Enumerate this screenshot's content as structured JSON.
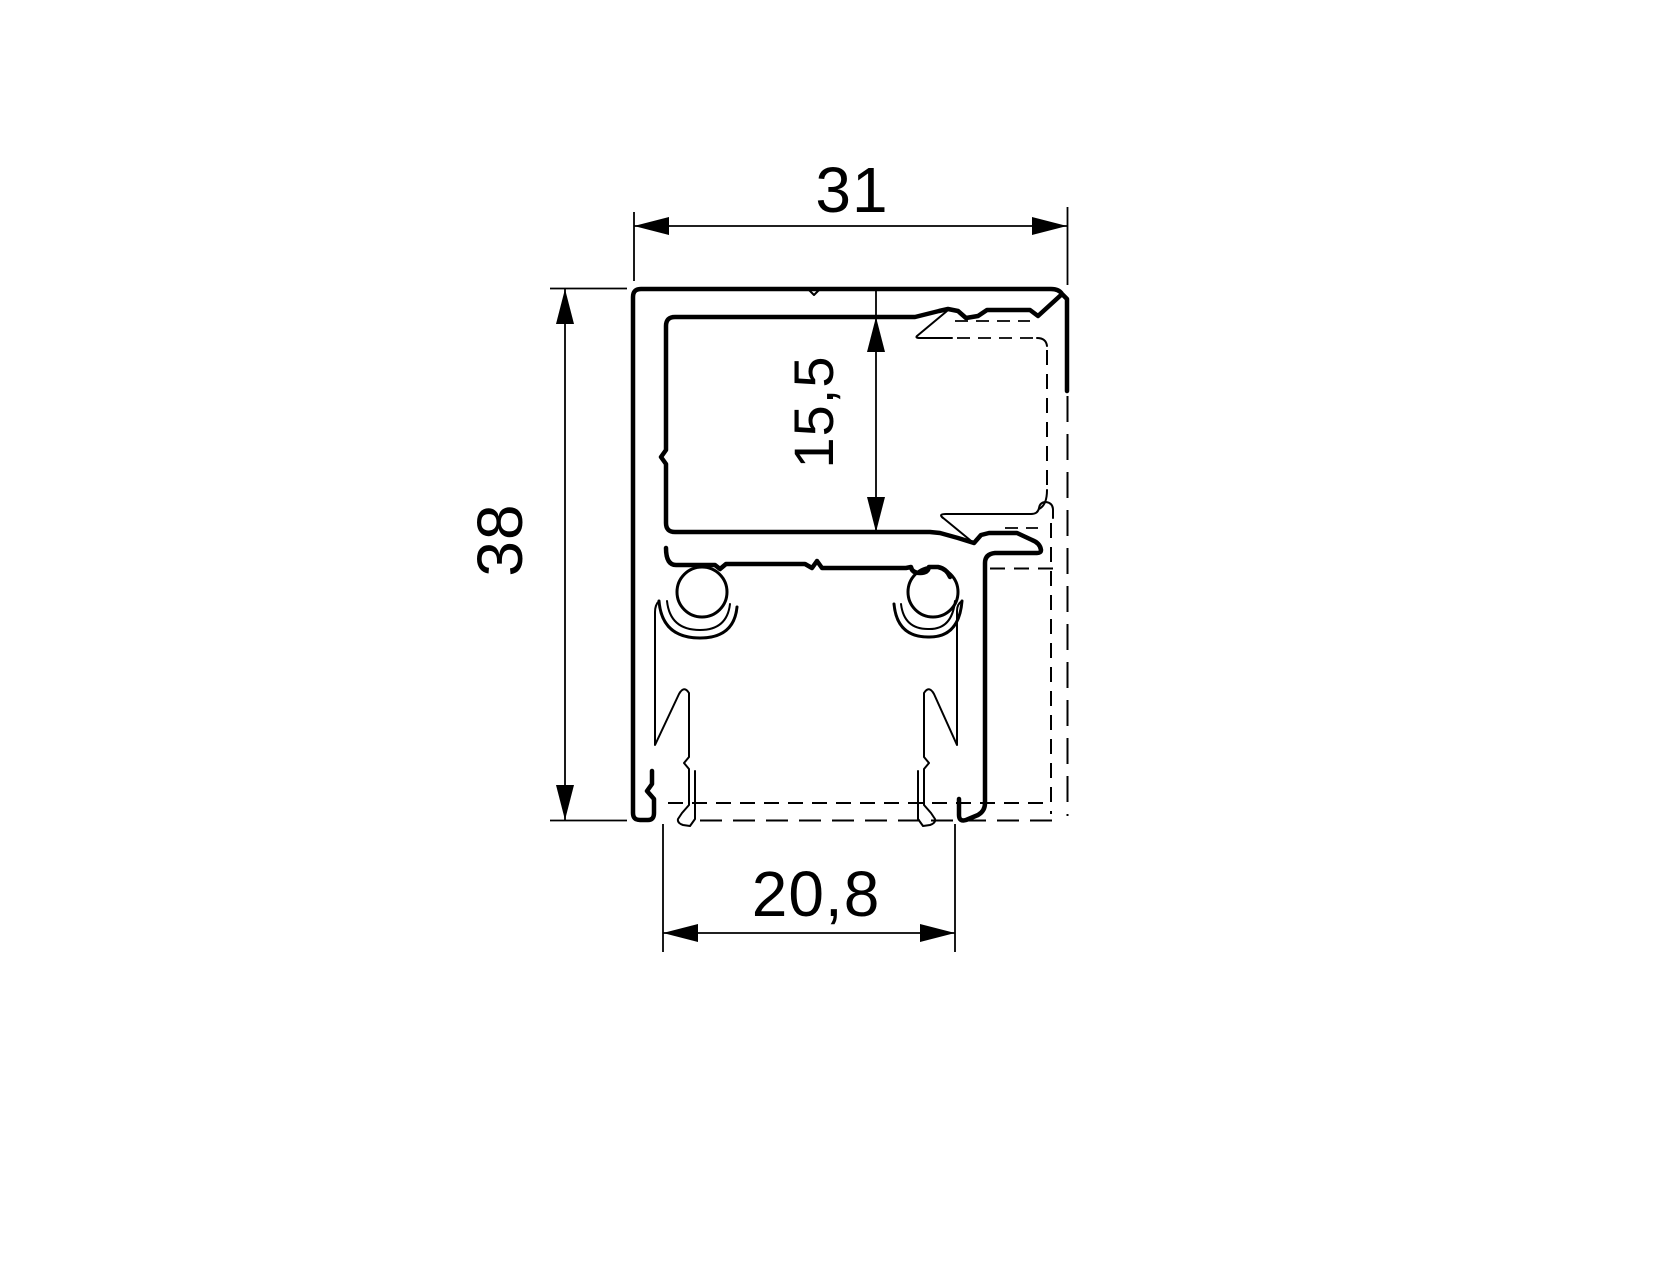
{
  "page": {
    "background_color": "#ffffff",
    "line_color": "#000000"
  },
  "drawing": {
    "dimensions": {
      "top_width": "31",
      "left_height": "38",
      "glazing_height": "15,5",
      "bottom_width": "20,8"
    }
  }
}
